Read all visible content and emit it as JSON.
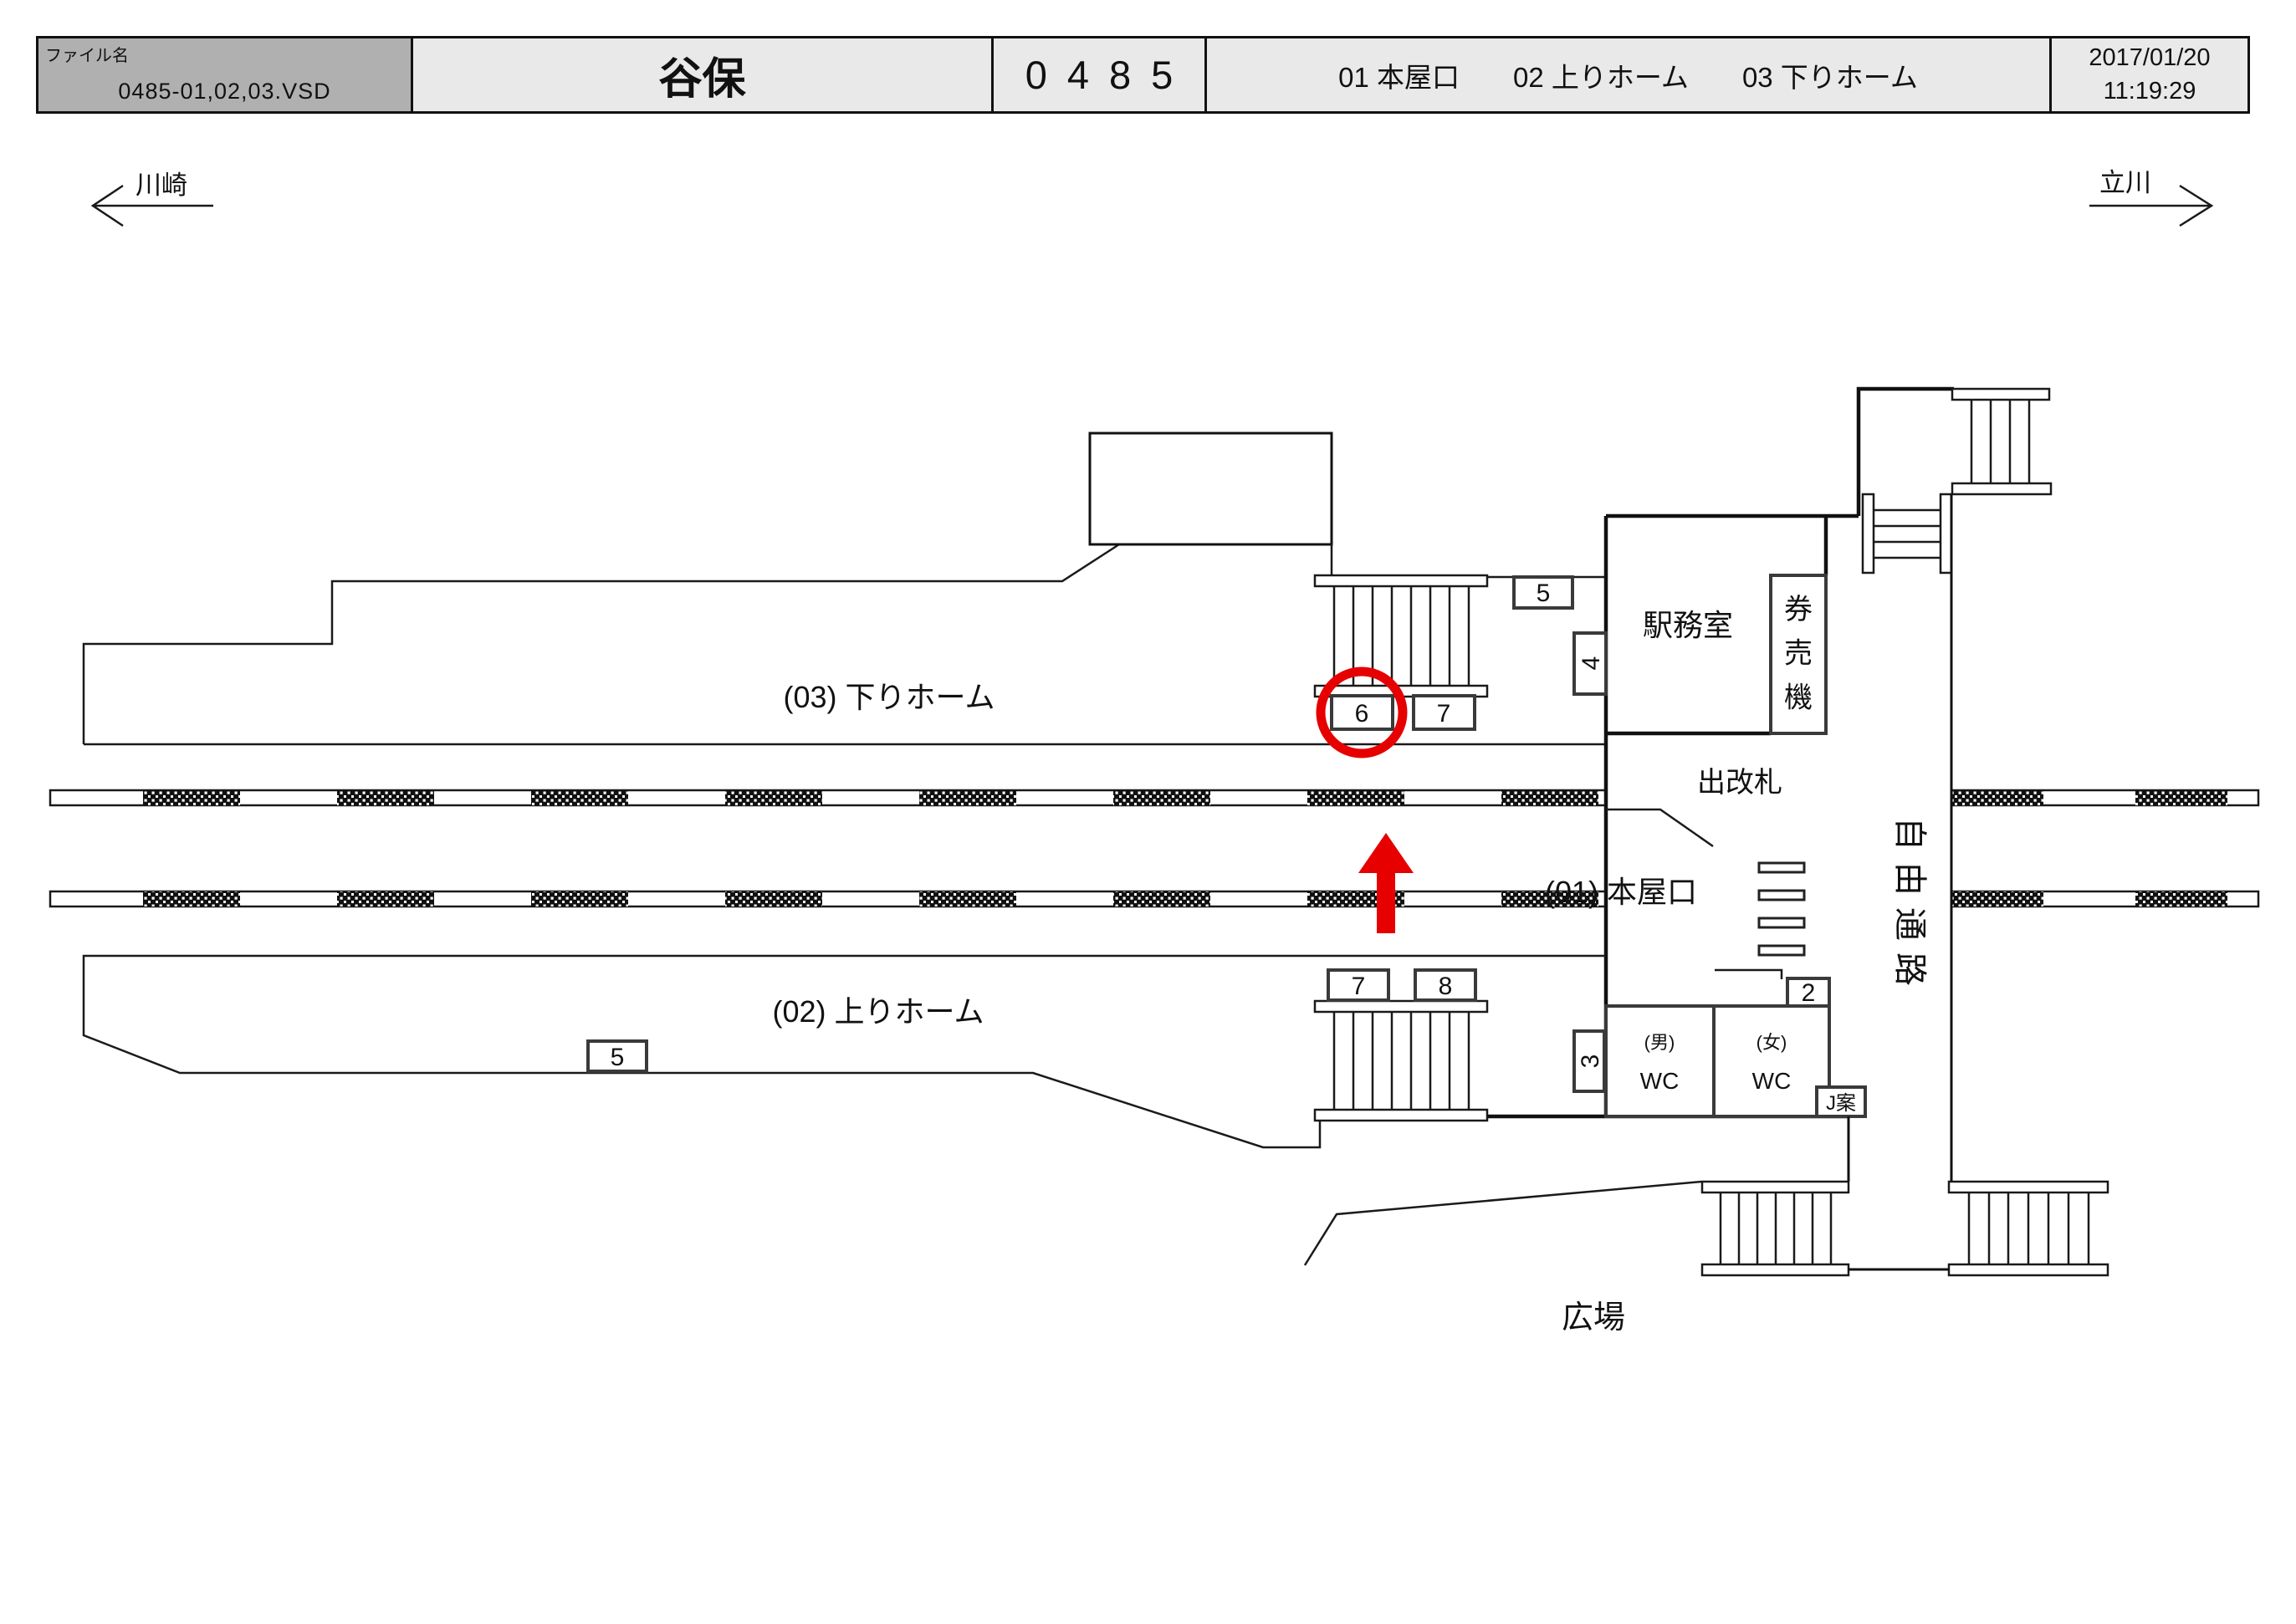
{
  "header": {
    "file_label": "ファイル名",
    "file_name": "0485-01,02,03.VSD",
    "station_name": "谷保",
    "station_code": "0485",
    "areas": [
      "01 本屋口",
      "02 上りホーム",
      "03 下りホーム"
    ],
    "date": "2017/01/20",
    "time": "11:19:29"
  },
  "directions": {
    "left": "川崎",
    "right": "立川"
  },
  "labels": {
    "platform_down": "(03) 下りホーム",
    "platform_up": "(02) 上りホーム",
    "main_gate": "(01) 本屋口",
    "station_office": "駅務室",
    "ticket_machines": "券売機",
    "ticket_gate": "出改札",
    "wc_men_note": "(男)",
    "wc_men": "WC",
    "wc_women_note": "(女)",
    "wc_women": "WC",
    "free_passage": "自由通路",
    "plaza": "広場",
    "j_sign": "J案"
  },
  "location_boxes": {
    "upper_5": "5",
    "upper_4": "4",
    "upper_6": "6",
    "upper_7": "7",
    "lower_7": "7",
    "lower_8": "8",
    "lower_5": "5",
    "side_3": "3",
    "side_2": "2"
  },
  "colors": {
    "highlight": "#e60000",
    "line": "#1a1a1a",
    "file_cell_bg": "#b0b0b0",
    "header_bg": "#e9e9e9"
  }
}
